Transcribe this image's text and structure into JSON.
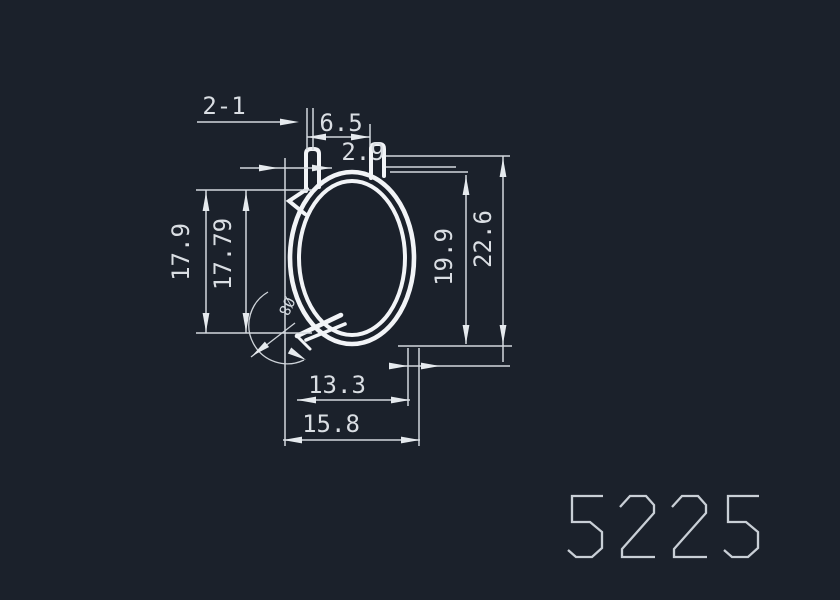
{
  "canvas": {
    "width": 840,
    "height": 600,
    "background": "#1b212b"
  },
  "colors": {
    "profile_stroke": "#f2f4f7",
    "dimension_stroke": "#d3d8de",
    "text_color": "#dadee3",
    "title_color": "#c9cfd6"
  },
  "drawing": {
    "type": "cad-profile-cross-section",
    "drawing_number": "5225",
    "labels": {
      "count_note": "2-1",
      "top_width": "6.5",
      "tab_width": "2.9",
      "left_height_outer": "17.9",
      "left_height_inner": "17.79",
      "right_height_inner": "19.9",
      "right_height_outer": "22.6",
      "bottom_width_inner": "13.3",
      "bottom_width_outer": "15.8",
      "diameter_note": "Ø8"
    }
  }
}
